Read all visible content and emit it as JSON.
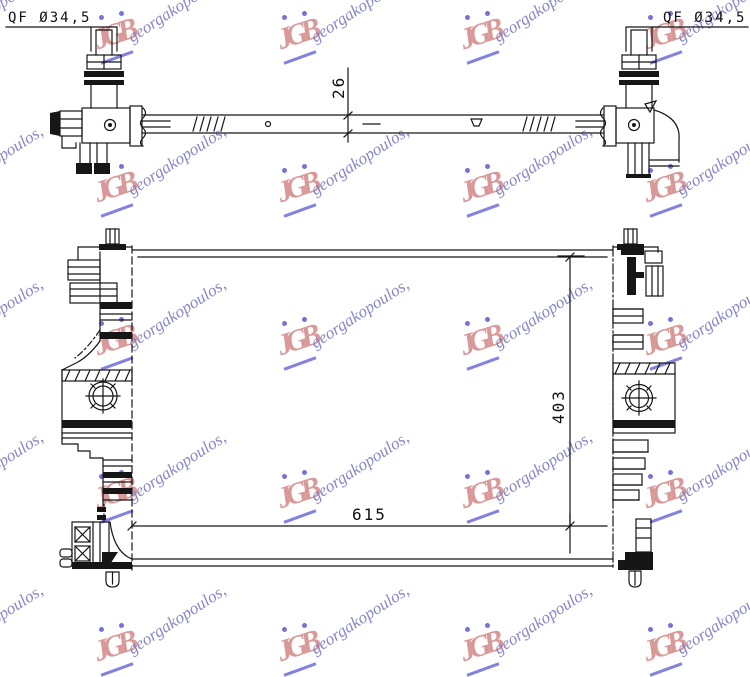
{
  "dimensions": {
    "fitting_left": "QF Ø34,5",
    "fitting_right": "QF Ø34,5",
    "crossbar_depth": "26",
    "core_width": "615",
    "core_height": "403"
  },
  "watermark": {
    "text": "georgakopoulos,",
    "monogram": "JGB",
    "text_color": "#7b7bc4",
    "monogram_color": "#cf7d7d",
    "accent_color": "#5a5ad2",
    "positions": [
      {
        "x": -63,
        "y": 42
      },
      {
        "x": 120,
        "y": 42
      },
      {
        "x": 303,
        "y": 42
      },
      {
        "x": 486,
        "y": 42
      },
      {
        "x": 669,
        "y": 42
      },
      {
        "x": -63,
        "y": 195
      },
      {
        "x": 120,
        "y": 195
      },
      {
        "x": 303,
        "y": 195
      },
      {
        "x": 486,
        "y": 195
      },
      {
        "x": 669,
        "y": 195
      },
      {
        "x": -63,
        "y": 348
      },
      {
        "x": 120,
        "y": 348
      },
      {
        "x": 303,
        "y": 348
      },
      {
        "x": 486,
        "y": 348
      },
      {
        "x": 669,
        "y": 348
      },
      {
        "x": -63,
        "y": 501
      },
      {
        "x": 120,
        "y": 501
      },
      {
        "x": 303,
        "y": 501
      },
      {
        "x": 486,
        "y": 501
      },
      {
        "x": 669,
        "y": 501
      },
      {
        "x": -63,
        "y": 654
      },
      {
        "x": 120,
        "y": 654
      },
      {
        "x": 303,
        "y": 654
      },
      {
        "x": 486,
        "y": 654
      },
      {
        "x": 669,
        "y": 654
      }
    ]
  },
  "line_color": "#161616"
}
